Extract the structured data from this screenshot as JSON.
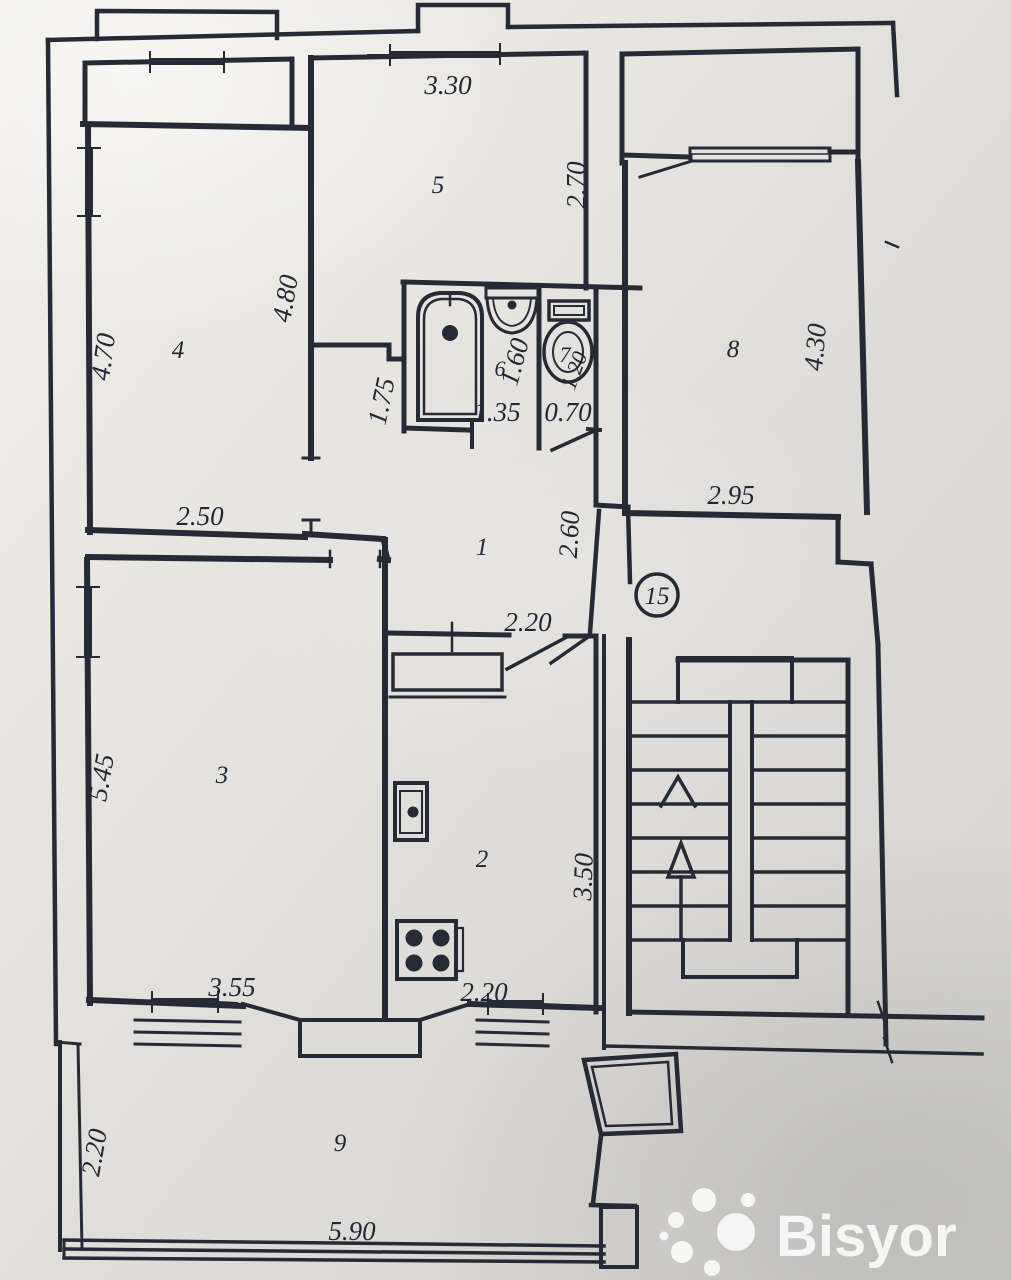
{
  "watermark": {
    "brand": "Bisyor"
  },
  "apartment": {
    "unit_number": "15"
  },
  "colors": {
    "ink": "#262a36",
    "paper": "#e7e5e0",
    "watermark_text": "#ffffff"
  },
  "rooms": {
    "hallway": "1",
    "kitchen": "2",
    "living_room": "3",
    "bedroom_left": "4",
    "bedroom_top": "5",
    "bathroom": "6",
    "toilet": "7",
    "bedroom_right": "8",
    "veranda": "9"
  },
  "dims": {
    "room5_width": "3.30",
    "room5_depth": "2.70",
    "room4_left": "4.70",
    "room4_right": "4.80",
    "room4_width": "2.50",
    "corridor": "1.75",
    "bath_depth": "1.60",
    "bath_width": "1.35",
    "toilet_width": "0.70",
    "toilet_depth": "1.20",
    "room8_depth": "4.30",
    "room8_width": "2.95",
    "hall_depth": "2.60",
    "hall_width": "2.20",
    "room3_depth": "5.45",
    "room3_width": "3.55",
    "kitchen_depth": "3.50",
    "kitchen_width": "2.20",
    "veranda_depth": "2.20",
    "veranda_width": "5.90"
  }
}
